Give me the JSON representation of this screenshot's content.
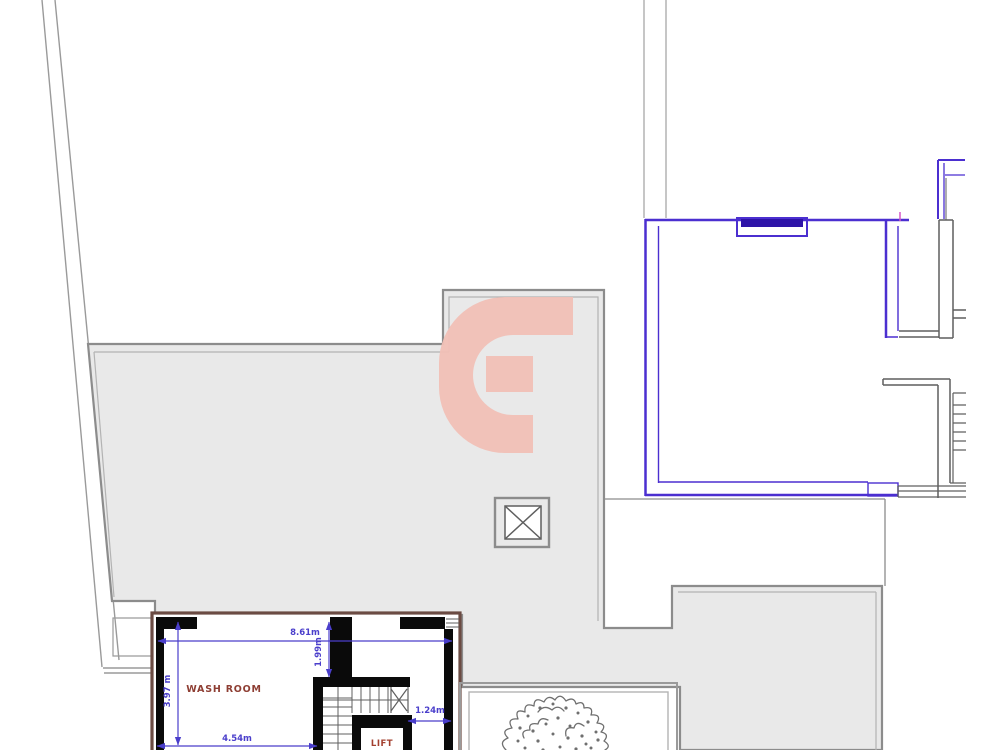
{
  "labels": {
    "wash_room": "WASH ROOM",
    "lift": "LIFT"
  },
  "dimensions": {
    "wash_room_top_width": "8.61m",
    "top_opening_height": "1.99m",
    "wash_room_left_height": "3.97 m",
    "wash_room_bottom_width": "4.54m",
    "lift_side_gap": "1.24m"
  },
  "symbols": {
    "watermark": "letter-G-watermark",
    "column_marker": "crossed-square-column",
    "tree": "tree-canopy-plan-symbol",
    "stairs": "stair-flight-with-break-line",
    "window": "window-in-wall"
  },
  "colors": {
    "fill_gray": "#e9e9e9",
    "line_gray": "#8c8c8c",
    "line_light": "#b3b3b3",
    "line_dark": "#5f5f5f",
    "wall_blue": "#4b2fd0",
    "window_blue": "#2e14a8",
    "dim_blue": "#4a3ecb",
    "label_red": "#8e3e33",
    "lift_red": "#a3402f",
    "wall_black": "#0a0a0a",
    "wall_brown": "#6b4b43",
    "watermark_pink": "#f1c0b6",
    "tree_gray": "#6f6f6f",
    "boundary_gray": "#9a9a9a"
  }
}
